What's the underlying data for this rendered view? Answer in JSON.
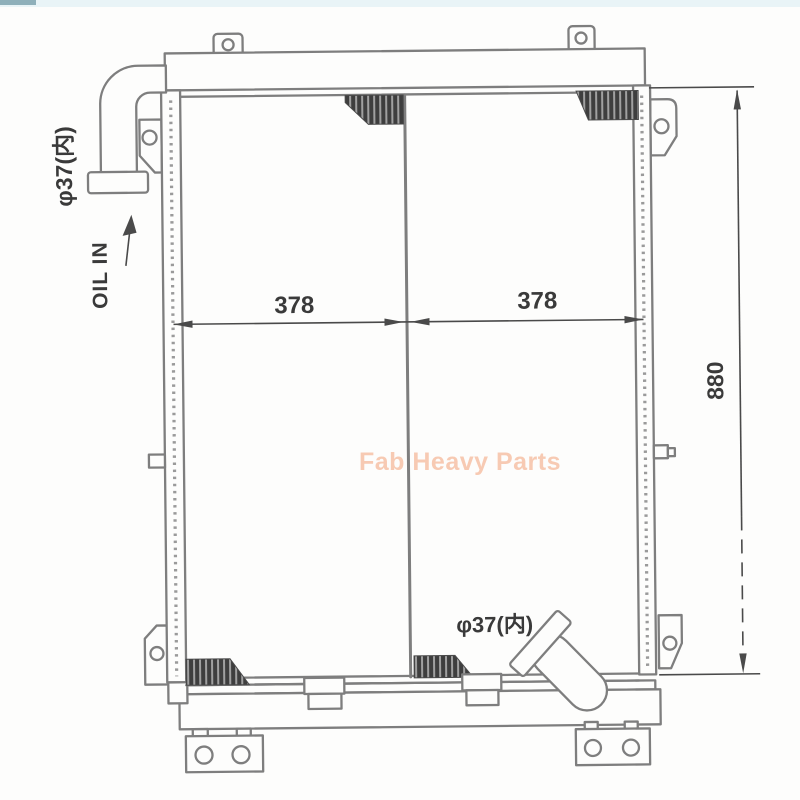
{
  "watermark": {
    "text": "Fab Heavy Parts"
  },
  "labels": {
    "inlet_diameter": "φ37(内)",
    "inlet_flow": "OIL IN",
    "outlet_diameter": "φ37(内)"
  },
  "dimensions": {
    "core_width_left": "378",
    "core_width_right": "378",
    "overall_height": "880"
  },
  "colors": {
    "background": "#fdfdfc",
    "line": "#7e7e7e",
    "line_dark": "#4a4a4a",
    "text": "#3a3a3a",
    "hatch_dark": "#3e3e3e",
    "hatch_light": "#a0a0a0",
    "watermark": "#f7c5ab",
    "top_strip": "#e9f4f7",
    "top_strip_accent": "#8fb0ba"
  }
}
